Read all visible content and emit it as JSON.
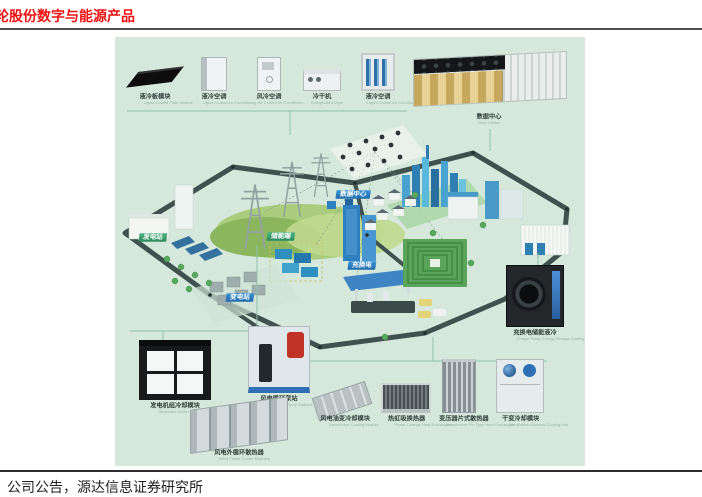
{
  "header": {
    "title": "轮股份数字与能源产品"
  },
  "footer": {
    "source": "公司公告，源达信息证券研究所"
  },
  "figure": {
    "top_products": [
      {
        "zh": "液冷板模块",
        "en": "Liquid Cooled Plate Module"
      },
      {
        "zh": "液冷空调",
        "en": "Liquid Cooled Air Conditioning"
      },
      {
        "zh": "风冷空调",
        "en": "Air Cooled Air Conditioner"
      },
      {
        "zh": "冷干机",
        "en": "Refrigerated Dryer"
      },
      {
        "zh": "液冷空调",
        "en": "Liquid Cooled Air Conditioning"
      }
    ],
    "data_center_label": {
      "zh": "数据中心",
      "en": "Data Center"
    },
    "map_badges": {
      "power_station": "发电站",
      "storage": "储能端",
      "data_center": "数据中心",
      "charging": "充换电",
      "substation": "变电站"
    },
    "right_product": {
      "zh": "充换电储能液冷",
      "en": "Charge Swap Energy Storage Cooling"
    },
    "bottom_left_products": [
      {
        "zh": "发电机组冷却模块",
        "en": "Generator Cooler Modules"
      },
      {
        "zh": "风电循环泵站",
        "en": "Wind Power Pump Stations"
      },
      {
        "zh": "风电外循环散热器",
        "en": "Wind Power Cooler Modules"
      }
    ],
    "bottom_right_products": [
      {
        "zh": "风电油变冷却模块",
        "en": "Transformer Cooling Module"
      },
      {
        "zh": "热虹吸换热器",
        "en": "Phase Change Heat Exchanger"
      },
      {
        "zh": "变压器片式散热器",
        "en": "Transformer Fin Type Heat Exchanger"
      },
      {
        "zh": "干变冷却模块",
        "en": "Transformer Blowers Cooling Unit"
      }
    ],
    "colors": {
      "background": "#d5e8db",
      "badge_blue": "#2e7fc0",
      "badge_green": "#3fa573",
      "title_red": "#ee1111"
    }
  }
}
